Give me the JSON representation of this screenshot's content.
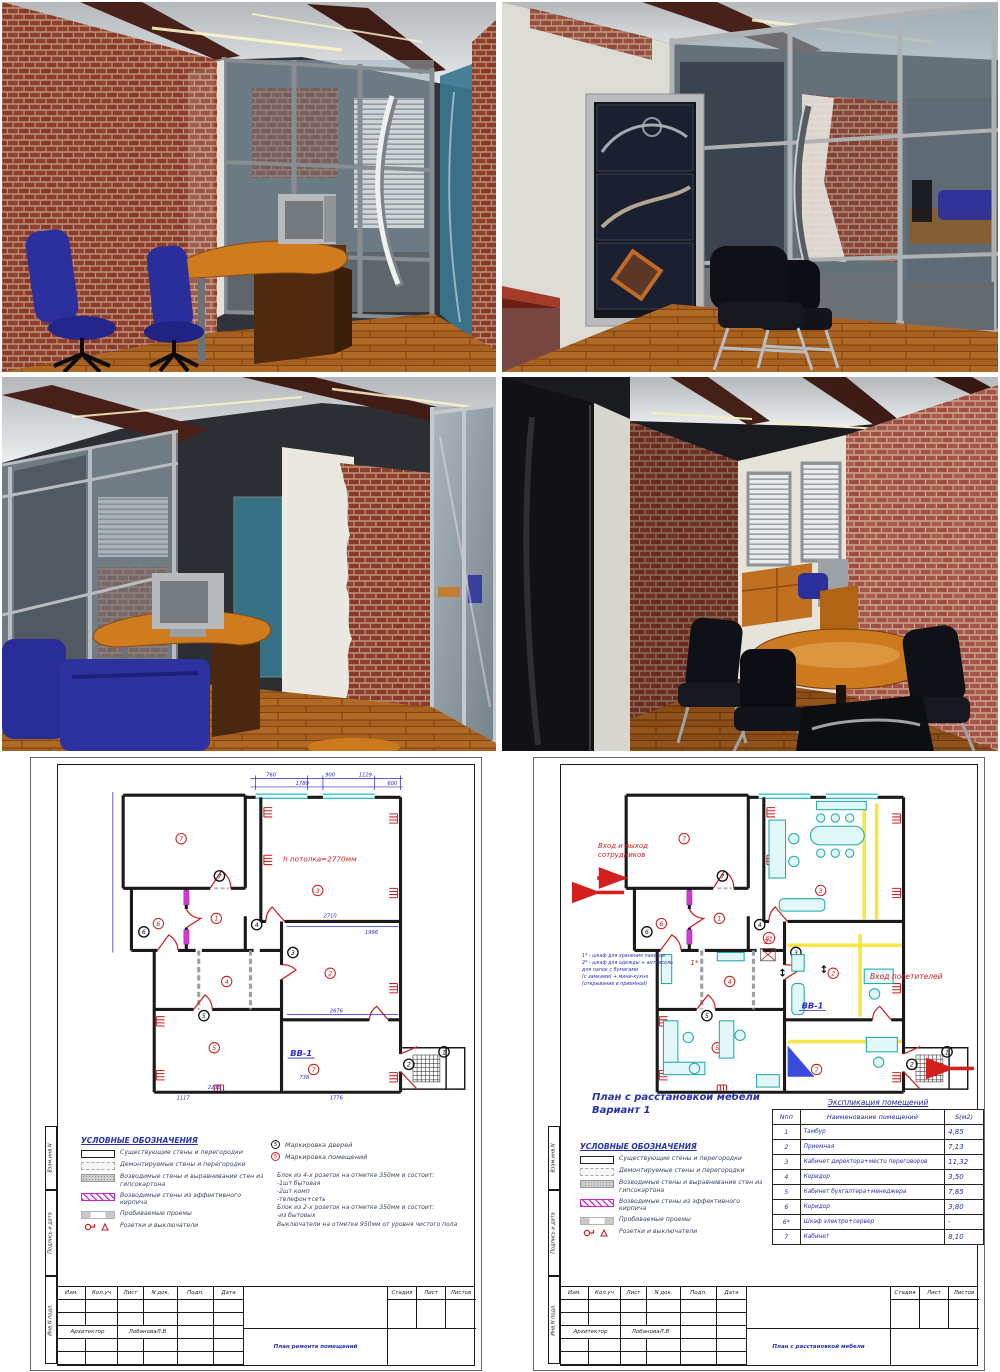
{
  "colors": {
    "brick": "#8d3a2b",
    "mortar": "#b98f76",
    "brick_light": "#a35042",
    "floor_wood": "#a8601f",
    "desk_wood": "#cf7c1e",
    "beam": "#47211a",
    "chair_blue": "#2c309e",
    "chair_black": "#121319",
    "glass": "#9fb4bf",
    "frame_metal": "#8d9296",
    "blue_glass": "#39768f",
    "wall_black": "#1a1a1a",
    "dim_blue": "#2a2ad0",
    "annot_red": "#cc2020",
    "window_cyan": "#2fc6c6",
    "new_wall_magenta": "#d23ad2",
    "text_blue": "#2431b4",
    "legend_text": "#3a4668",
    "furniture_teal": "#1fa8a8",
    "highlight_yellow": "#f0e428"
  },
  "shared": {
    "room_numbers": [
      "1",
      "2",
      "3",
      "4",
      "5",
      "6",
      "7"
    ],
    "room6star": "6*",
    "legend": {
      "title": "УСЛОВНЫЕ ОБОЗНАЧЕНИЯ",
      "items": [
        "Существующие стены и перегородки",
        "Демонтируемые стены и перегородки",
        "Возводимые стены и выравнивание стен из гипсокартона",
        "Возводимые стены из эффективного кирпича",
        "Пробиваемые проемы",
        "Розетки и выключатели"
      ]
    },
    "title_block": {
      "izm": "Изм.",
      "kol_uch": "Кол.уч",
      "list": "Лист",
      "n_dok": "N док.",
      "podp": "Подп.",
      "data": "Дата",
      "stadia": "Стадия",
      "list2": "Лист",
      "listov": "Листов",
      "architect_role": "Архитектор",
      "architect_name": "ЛобановаЛ.В"
    },
    "side_labels": {
      "top": "Взам.инв.N",
      "middle": "Подпись и дата",
      "bottom": "Инв.N подл."
    }
  },
  "sheet_left": {
    "title": "План ремонта помещений",
    "marking": {
      "doors_num": "5",
      "doors_label": "Маркировка дверей",
      "rooms_num": "5",
      "rooms_label": "Маркировка помещений"
    },
    "notes": [
      "Блок из 4-х розеток на отметке 350мм и состоит:",
      "-1шт бытовая",
      "-2шт комп",
      "-телефон+сеть",
      "Блок из 2-х розеток на отметке 350мм и состоит:",
      "-из бытовых",
      "Выключатели на отметке 950мм от уровня чистого пола"
    ],
    "annotations": {
      "ceiling_height": "h потолка=2770мм",
      "vv1": "ВВ-1"
    },
    "dims_top": [
      "760",
      "1780",
      "900",
      "1129",
      "600"
    ],
    "dims_inner": [
      "2710",
      "1996",
      "2676",
      "2238",
      "1117",
      "1776",
      "738"
    ]
  },
  "sheet_right": {
    "title": "План с расстановкой мебели",
    "heading_line1": "План с расстановкой мебели",
    "heading_line2": "Вариант 1",
    "explication": {
      "title": "Экспликация помещений",
      "col_n": "Nпп",
      "col_name": "Наименование помещений",
      "col_s": "S(м2)",
      "rows": [
        {
          "n": "1",
          "name": "Тамбур",
          "s": "4,85"
        },
        {
          "n": "2",
          "name": "Приемная",
          "s": "7,13"
        },
        {
          "n": "3",
          "name": "Кабинет директора+место переговоров",
          "s": "11,32"
        },
        {
          "n": "4",
          "name": "Коридор",
          "s": "3,50"
        },
        {
          "n": "5",
          "name": "Кабинет бухгалтера+менеджера",
          "s": "7,85"
        },
        {
          "n": "6",
          "name": "Коридор",
          "s": "3,80"
        },
        {
          "n": "6*",
          "name": "Шкаф электро+сервер",
          "s": "-"
        },
        {
          "n": "7",
          "name": "Кабинет",
          "s": "8,10"
        }
      ]
    },
    "annotations": {
      "staff_entrance": "Вход и выход сотрудников",
      "visitors_entrance": "Вход посетителей",
      "vv1": "ВВ-1",
      "closet1": "1*",
      "closet2": "2*"
    },
    "notes": [
      "1* - шкаф для хранения пакетов",
      "2* - шкаф для одежды + антресоль",
      "для папок с бумагами",
      "(с замками) + мини-кухня",
      "(открывание в приемной)"
    ]
  }
}
